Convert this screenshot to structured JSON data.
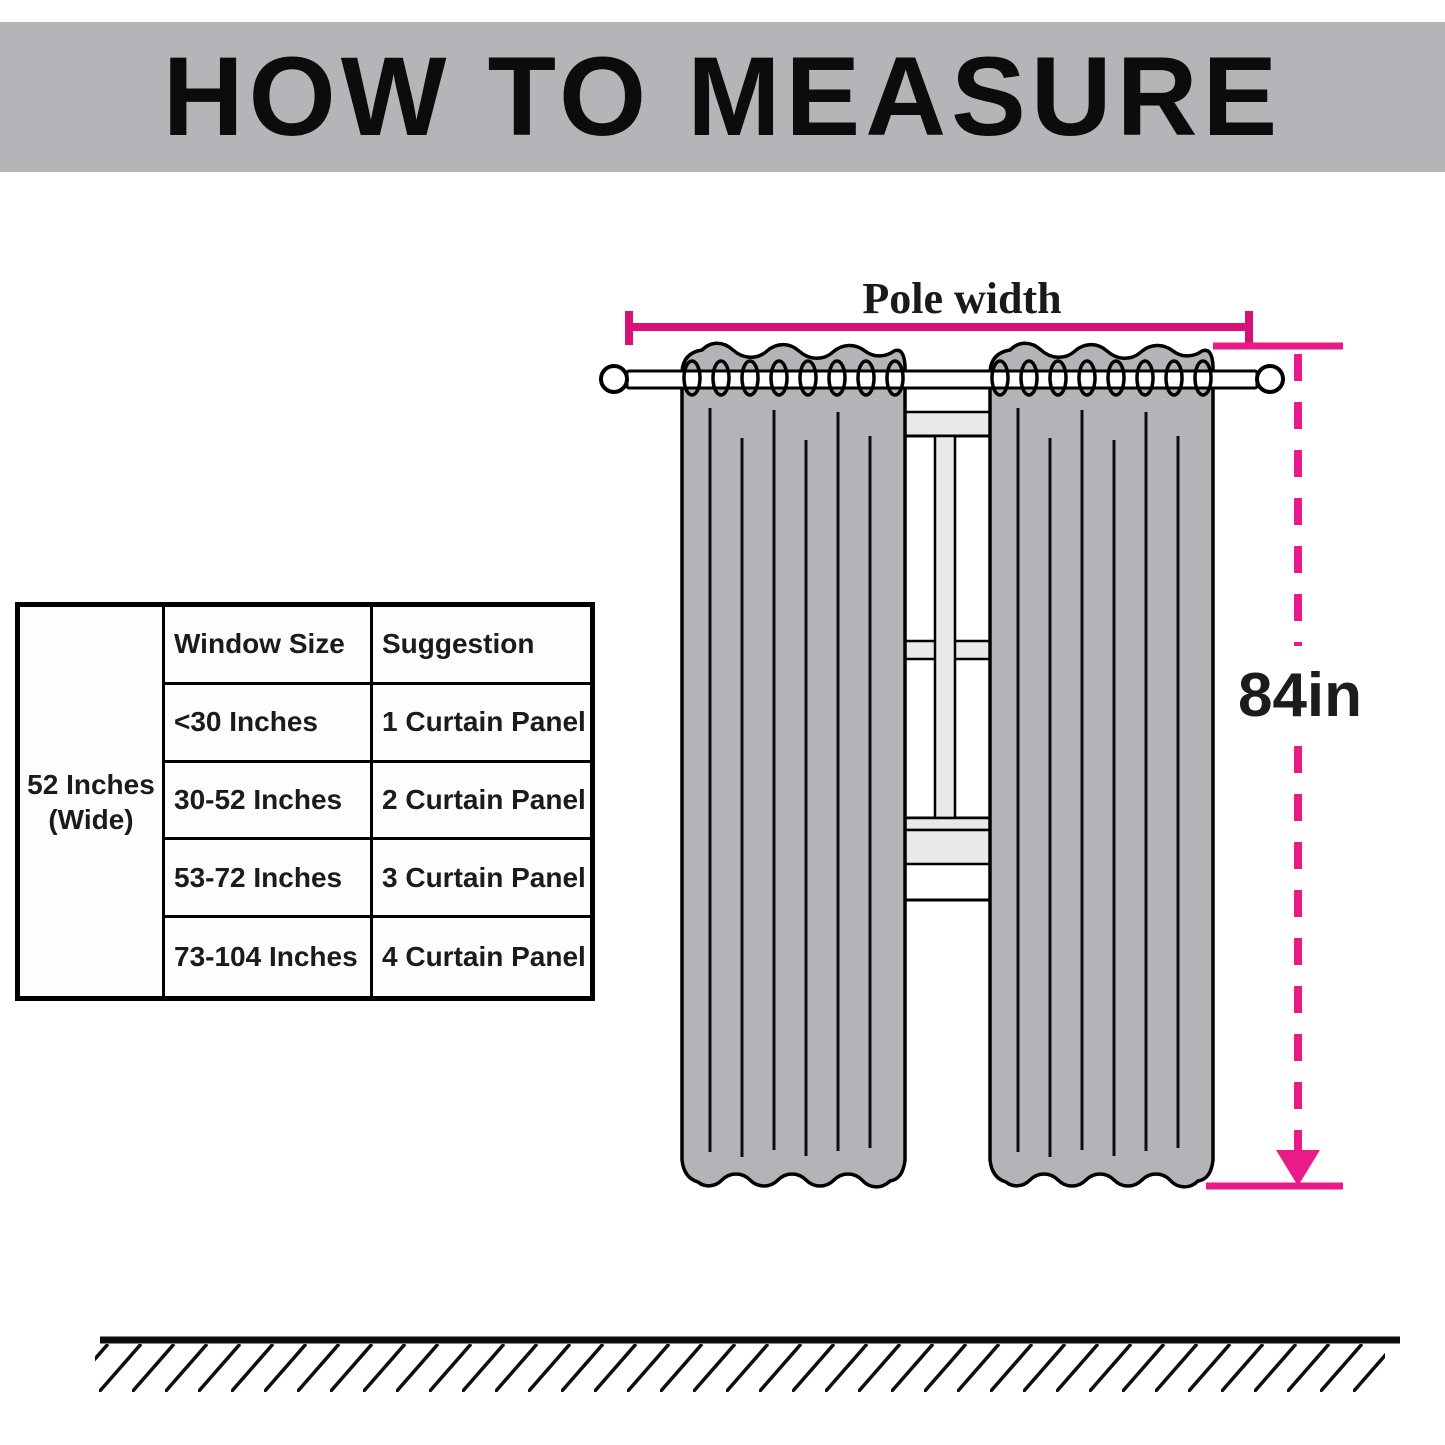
{
  "banner": {
    "title": "HOW TO MEASURE"
  },
  "diagram": {
    "pole_width_label": "Pole width",
    "drop_length_label": "84in"
  },
  "table": {
    "side_header": {
      "line1": "52 Inches",
      "line2": "(Wide)"
    },
    "columns": [
      "Window Size",
      "Suggestion"
    ],
    "rows": [
      {
        "window": "<30 Inches",
        "suggestion": "1 Curtain Panel"
      },
      {
        "window": "30-52 Inches",
        "suggestion": "2 Curtain Panel"
      },
      {
        "window": "53-72 Inches",
        "suggestion": "3 Curtain Panel"
      },
      {
        "window": "73-104 Inches",
        "suggestion": "4 Curtain Panel"
      }
    ]
  },
  "colors": {
    "banner_bg": "#b5b4b8",
    "curtain_fill": "#b4b3b8",
    "window_bar_fill": "#e9e9eb",
    "accent_pink": "#d81077",
    "accent_pink_bright": "#ea1a87",
    "line_black": "#0d0d0d",
    "text_black": "#1b1b1b"
  }
}
